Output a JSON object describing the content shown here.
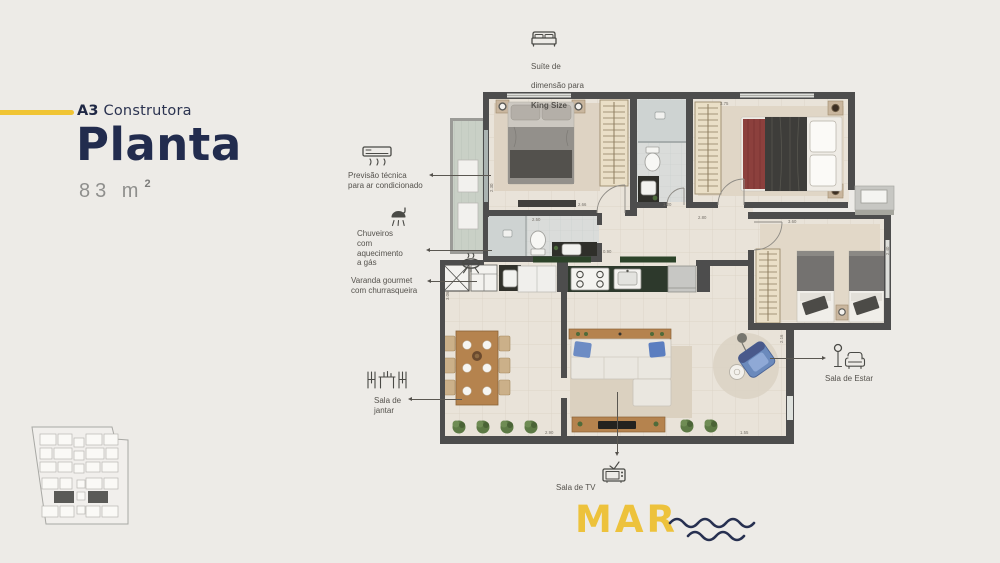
{
  "header": {
    "brand_bold": "A3",
    "brand_rest": " Construtora",
    "title": "Planta",
    "area_value": "83 m",
    "area_sup": "2"
  },
  "callouts": {
    "suite": {
      "line1": "Suíte de",
      "line2": "dimensão para",
      "line3": "King Size"
    },
    "ac": {
      "text": "Previsão técnica\npara ar condicionado"
    },
    "shower": {
      "text": "Chuveiros\ncom\naquecimento\na gás"
    },
    "varanda": {
      "text": "Varanda gourmet\ncom churrasqueira"
    },
    "jantar": {
      "text": "Sala de\njantar"
    },
    "estar": {
      "text": "Sala de Estar"
    },
    "tv": {
      "text": "Sala de TV"
    }
  },
  "footer": {
    "mar": "MAR"
  },
  "colors": {
    "background": "#edebe7",
    "navy": "#222c4e",
    "yellow": "#f0c434",
    "wall": "#4d4d4d",
    "label_gray": "#55524d"
  },
  "plan": {
    "dimensions": [
      {
        "t": "2.66",
        "x": 578,
        "y": 206
      },
      {
        "t": "2.30",
        "x": 493,
        "y": 192,
        "r": -90
      },
      {
        "t": "2.50",
        "x": 532,
        "y": 221
      },
      {
        "t": "1.20",
        "x": 663,
        "y": 206
      },
      {
        "t": "2.80",
        "x": 698,
        "y": 219
      },
      {
        "t": "3.75",
        "x": 720,
        "y": 105
      },
      {
        "t": "3.60",
        "x": 788,
        "y": 223
      },
      {
        "t": "2.40",
        "x": 889,
        "y": 255,
        "r": -90
      },
      {
        "t": "0.90",
        "x": 603,
        "y": 253
      },
      {
        "t": "2.90",
        "x": 545,
        "y": 434
      },
      {
        "t": "1.55",
        "x": 740,
        "y": 434
      },
      {
        "t": "3.06",
        "x": 449,
        "y": 300,
        "r": -90
      },
      {
        "t": "2.16",
        "x": 783,
        "y": 343,
        "r": -90
      }
    ]
  }
}
